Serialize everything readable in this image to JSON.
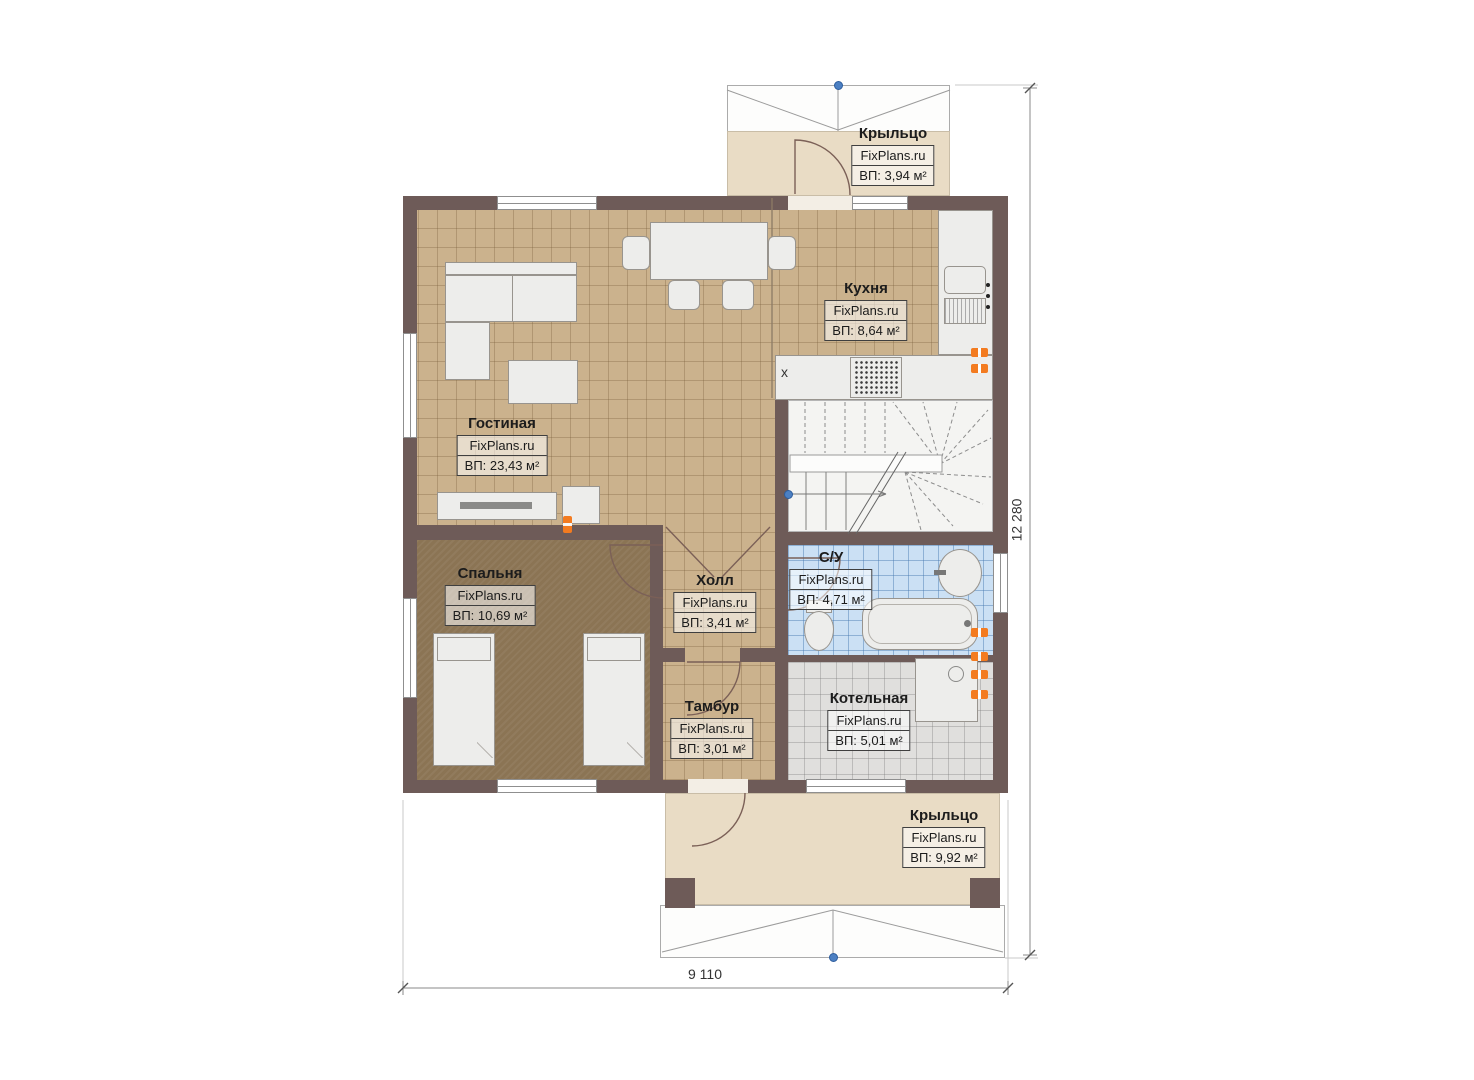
{
  "rooms": {
    "porch_top": {
      "name": "Крыльцо",
      "brand": "FixPlans.ru",
      "area": "ВП: 3,94 м²"
    },
    "kitchen": {
      "name": "Кухня",
      "brand": "FixPlans.ru",
      "area": "ВП: 8,64 м²"
    },
    "living": {
      "name": "Гостиная",
      "brand": "FixPlans.ru",
      "area": "ВП: 23,43 м²"
    },
    "bedroom": {
      "name": "Спальня",
      "brand": "FixPlans.ru",
      "area": "ВП: 10,69 м²"
    },
    "hall": {
      "name": "Холл",
      "brand": "FixPlans.ru",
      "area": "ВП: 3,41 м²"
    },
    "bathroom": {
      "name": "С/У",
      "brand": "FixPlans.ru",
      "area": "ВП: 4,71 м²"
    },
    "tambour": {
      "name": "Тамбур",
      "brand": "FixPlans.ru",
      "area": "ВП: 3,01 м²"
    },
    "boiler": {
      "name": "Котельная",
      "brand": "FixPlans.ru",
      "area": "ВП: 5,01 м²"
    },
    "porch_bottom": {
      "name": "Крыльцо",
      "brand": "FixPlans.ru",
      "area": "ВП: 9,92 м²"
    }
  },
  "dimensions": {
    "vertical": "12 280",
    "horizontal": "9 110"
  },
  "marks": {
    "kitchen_x": "x"
  },
  "colors": {
    "wall": "#6e5b58",
    "tile_tan": "#cbb28d",
    "carpet": "#8b7454",
    "tile_blue": "#cbe0f4",
    "tile_gray": "#e0dfdd",
    "porch": "#e9dcc5",
    "radiator": "#f37b20",
    "marker": "#4c80c3"
  }
}
